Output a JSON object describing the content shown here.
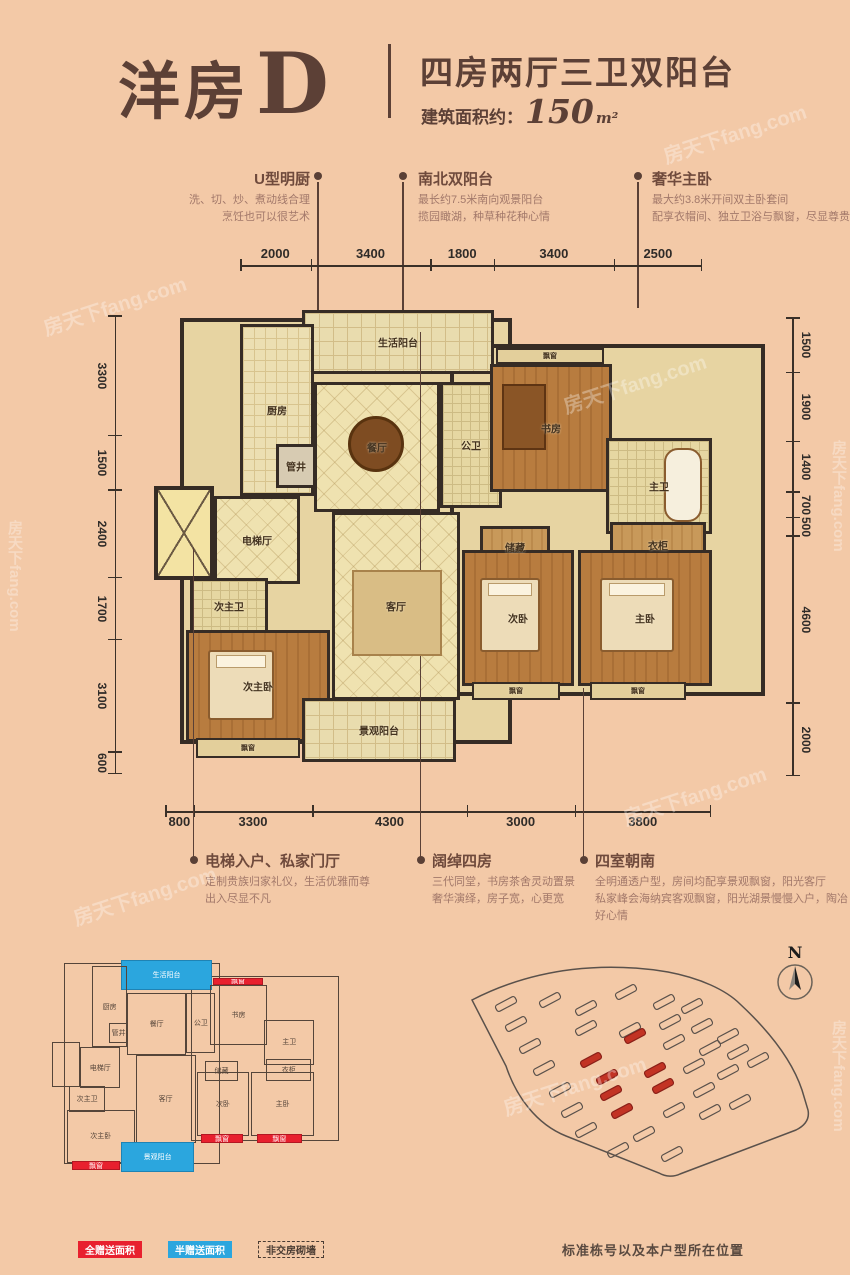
{
  "header": {
    "title": "洋房",
    "title_letter": "D",
    "subtitle": "四房两厅三卫双阳台",
    "area_label": "建筑面积约：",
    "area_value": "150",
    "area_unit": "m²"
  },
  "callouts_top": [
    {
      "title": "U型明厨",
      "desc1": "洗、切、炒、煮动线合理",
      "desc2": "烹饪也可以很艺术"
    },
    {
      "title": "南北双阳台",
      "desc1": "最长约7.5米南向观景阳台",
      "desc2": "揽园瞰湖，种草种花种心情"
    },
    {
      "title": "奢华主卧",
      "desc1": "最大约3.8米开间双主卧套间",
      "desc2": "配享衣帽间、独立卫浴与飘窗，尽显尊贵"
    }
  ],
  "callouts_bottom": [
    {
      "title": "电梯入户、私家门厅",
      "desc1": "定制贵族归家礼仪，生活优雅而尊",
      "desc2": "出入尽显不凡"
    },
    {
      "title": "阔绰四房",
      "desc1": "三代同堂，书房茶舍灵动置景",
      "desc2": "奢华演绎，房子宽，心更宽"
    },
    {
      "title": "四室朝南",
      "desc1": "全明通透户型，房间均配享景观飘窗，阳光客厅",
      "desc2": "私家峰会海纳宾客观飘窗，阳光湖景慢慢入户，陶冶好心情"
    }
  ],
  "dims": {
    "top": [
      "2000",
      "3400",
      "1800",
      "3400",
      "2500"
    ],
    "bottom": [
      "800",
      "3300",
      "4300",
      "3000",
      "3800"
    ],
    "left": [
      "3300",
      "1500",
      "2400",
      "1700",
      "3100",
      "600"
    ],
    "right": [
      "1500",
      "1900",
      "1400",
      "700",
      "500",
      "4600",
      "2000"
    ]
  },
  "plan": {
    "slabs": [
      {
        "x": 30,
        "y": 20,
        "w": 332,
        "h": 426
      },
      {
        "x": 300,
        "y": 46,
        "w": 315,
        "h": 352
      }
    ],
    "rooms": [
      {
        "label": "生活阳台",
        "x": 152,
        "y": 12,
        "w": 192,
        "h": 64,
        "t": "balcony",
        "g": "half"
      },
      {
        "label": "厨房",
        "x": 90,
        "y": 26,
        "w": 74,
        "h": 172,
        "t": "tile"
      },
      {
        "label": "餐厅",
        "x": 164,
        "y": 84,
        "w": 126,
        "h": 130,
        "t": "tile2"
      },
      {
        "label": "管井",
        "x": 126,
        "y": 146,
        "w": 40,
        "h": 44,
        "t": "grey"
      },
      {
        "label": "公卫",
        "x": 290,
        "y": 84,
        "w": 62,
        "h": 126,
        "t": "bath"
      },
      {
        "label": "飘窗",
        "x": 346,
        "y": 50,
        "w": 108,
        "h": 16,
        "t": "bay",
        "g": "full"
      },
      {
        "label": "书房",
        "x": 340,
        "y": 66,
        "w": 122,
        "h": 128,
        "t": "wood"
      },
      {
        "label": "主卫",
        "x": 456,
        "y": 140,
        "w": 106,
        "h": 96,
        "t": "bath"
      },
      {
        "label": "衣柜",
        "x": 460,
        "y": 224,
        "w": 96,
        "h": 46,
        "t": "woodlight"
      },
      {
        "label": "储藏",
        "x": 330,
        "y": 228,
        "w": 70,
        "h": 42,
        "t": "woodlight"
      },
      {
        "label": "电梯厅",
        "x": 64,
        "y": 198,
        "w": 86,
        "h": 88,
        "t": "tile2"
      },
      {
        "label": "",
        "x": 4,
        "y": 188,
        "w": 60,
        "h": 94,
        "t": "shaft"
      },
      {
        "label": "次主卫",
        "x": 40,
        "y": 280,
        "w": 78,
        "h": 56,
        "t": "bath"
      },
      {
        "label": "客厅",
        "x": 182,
        "y": 214,
        "w": 128,
        "h": 188,
        "t": "tile2"
      },
      {
        "label": "次主卧",
        "x": 36,
        "y": 332,
        "w": 144,
        "h": 112,
        "t": "wood"
      },
      {
        "label": "飘窗",
        "x": 46,
        "y": 440,
        "w": 104,
        "h": 20,
        "t": "bay",
        "g": "full"
      },
      {
        "label": "景观阳台",
        "x": 152,
        "y": 400,
        "w": 154,
        "h": 64,
        "t": "balcony",
        "g": "half"
      },
      {
        "label": "次卧",
        "x": 312,
        "y": 252,
        "w": 112,
        "h": 136,
        "t": "wood"
      },
      {
        "label": "主卧",
        "x": 428,
        "y": 252,
        "w": 134,
        "h": 136,
        "t": "wood"
      },
      {
        "label": "飘窗",
        "x": 322,
        "y": 384,
        "w": 88,
        "h": 18,
        "t": "bay",
        "g": "full"
      },
      {
        "label": "飘窗",
        "x": 440,
        "y": 384,
        "w": 96,
        "h": 18,
        "t": "bay",
        "g": "full"
      }
    ],
    "furniture": [
      {
        "t": "table",
        "x": 198,
        "y": 118,
        "w": 56,
        "h": 56
      },
      {
        "t": "rug",
        "x": 202,
        "y": 272,
        "w": 90,
        "h": 86
      },
      {
        "t": "bed",
        "x": 58,
        "y": 352,
        "w": 66,
        "h": 70
      },
      {
        "t": "bed",
        "x": 330,
        "y": 280,
        "w": 60,
        "h": 74
      },
      {
        "t": "bed",
        "x": 450,
        "y": 280,
        "w": 74,
        "h": 74
      },
      {
        "t": "tub",
        "x": 514,
        "y": 150,
        "w": 38,
        "h": 74
      },
      {
        "t": "desk",
        "x": 352,
        "y": 86,
        "w": 44,
        "h": 66
      }
    ]
  },
  "legend": [
    {
      "label": "全赠送面积",
      "c": "red"
    },
    {
      "label": "半赠送面积",
      "c": "blue"
    },
    {
      "label": "非交房砌墙",
      "c": "dashed"
    }
  ],
  "site": {
    "compass_label": "N",
    "caption": "标准栋号以及本户型所在位置",
    "buildings": [
      {
        "x": 38,
        "y": 66
      },
      {
        "x": 82,
        "y": 62
      },
      {
        "x": 118,
        "y": 70
      },
      {
        "x": 158,
        "y": 54
      },
      {
        "x": 196,
        "y": 64
      },
      {
        "x": 224,
        "y": 68
      },
      {
        "x": 48,
        "y": 86
      },
      {
        "x": 118,
        "y": 90
      },
      {
        "x": 162,
        "y": 92
      },
      {
        "x": 202,
        "y": 84
      },
      {
        "x": 234,
        "y": 88
      },
      {
        "x": 260,
        "y": 98
      },
      {
        "x": 62,
        "y": 108
      },
      {
        "x": 206,
        "y": 104
      },
      {
        "x": 242,
        "y": 110
      },
      {
        "x": 270,
        "y": 114
      },
      {
        "x": 290,
        "y": 122
      },
      {
        "x": 76,
        "y": 130
      },
      {
        "x": 226,
        "y": 128
      },
      {
        "x": 260,
        "y": 134
      },
      {
        "x": 92,
        "y": 152
      },
      {
        "x": 236,
        "y": 152
      },
      {
        "x": 272,
        "y": 164
      },
      {
        "x": 104,
        "y": 172
      },
      {
        "x": 206,
        "y": 172
      },
      {
        "x": 242,
        "y": 174
      },
      {
        "x": 118,
        "y": 192
      },
      {
        "x": 176,
        "y": 196
      },
      {
        "x": 150,
        "y": 212
      },
      {
        "x": 204,
        "y": 216
      },
      {
        "x": 167,
        "y": 98,
        "hl": true
      },
      {
        "x": 123,
        "y": 122,
        "hl": true
      },
      {
        "x": 187,
        "y": 132,
        "hl": true
      },
      {
        "x": 139,
        "y": 139,
        "hl": true
      },
      {
        "x": 195,
        "y": 148,
        "hl": true
      },
      {
        "x": 143,
        "y": 155,
        "hl": true
      },
      {
        "x": 154,
        "y": 173,
        "hl": true
      }
    ]
  },
  "watermark": "房天下fang.com"
}
